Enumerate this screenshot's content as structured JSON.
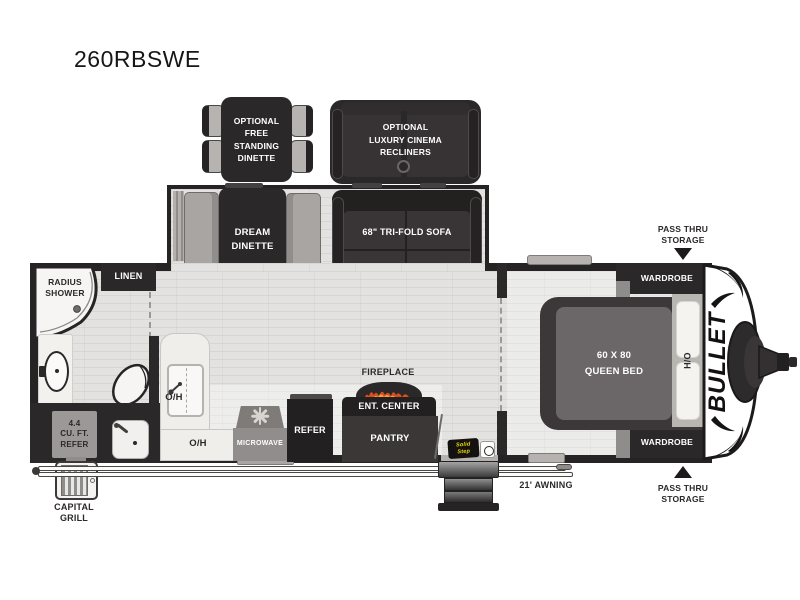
{
  "title": "260RBSWE",
  "floorplan": {
    "options": {
      "free_standing_dinette": "OPTIONAL\nFREE\nSTANDING\nDINETTE",
      "cinema_recliners": "OPTIONAL\nLUXURY CINEMA\nRECLINERS"
    },
    "slideout": {
      "dream_dinette": "DREAM\nDINETTE",
      "sofa": "68\" TRI-FOLD SOFA"
    },
    "bedroom": {
      "bed": "60 X 80\nQUEEN BED",
      "overhead": "H/O",
      "wardrobe_top": "WARDROBE",
      "wardrobe_bottom": "WARDROBE",
      "pass_thru_top": "PASS THRU\nSTORAGE",
      "pass_thru_bottom": "PASS THRU\nSTORAGE"
    },
    "bathroom": {
      "shower": "RADIUS\nSHOWER",
      "linen": "LINEN"
    },
    "kitchen": {
      "overhead_upper": "O/H",
      "overhead_lower": "O/H",
      "microwave": "MICROWAVE",
      "refer": "REFER",
      "fireplace": "FIREPLACE",
      "ent_center": "ENT. CENTER",
      "pantry": "PANTRY"
    },
    "exterior": {
      "outdoor_refer": "4.4\nCU. FT.\nREFER",
      "capital_grill": "CAPITAL\nGRILL",
      "awning": "21' AWNING",
      "solid_step": "Solid\nStep",
      "brand": "BULLET"
    }
  },
  "colors": {
    "wall": "#2b2829",
    "furniture_gray": "#a8a5a2",
    "floor": "#e3e2e0",
    "flame_orange": "#d84f1e",
    "flame_yellow": "#f5a03a",
    "solid_step_yellow": "#f3df00"
  }
}
